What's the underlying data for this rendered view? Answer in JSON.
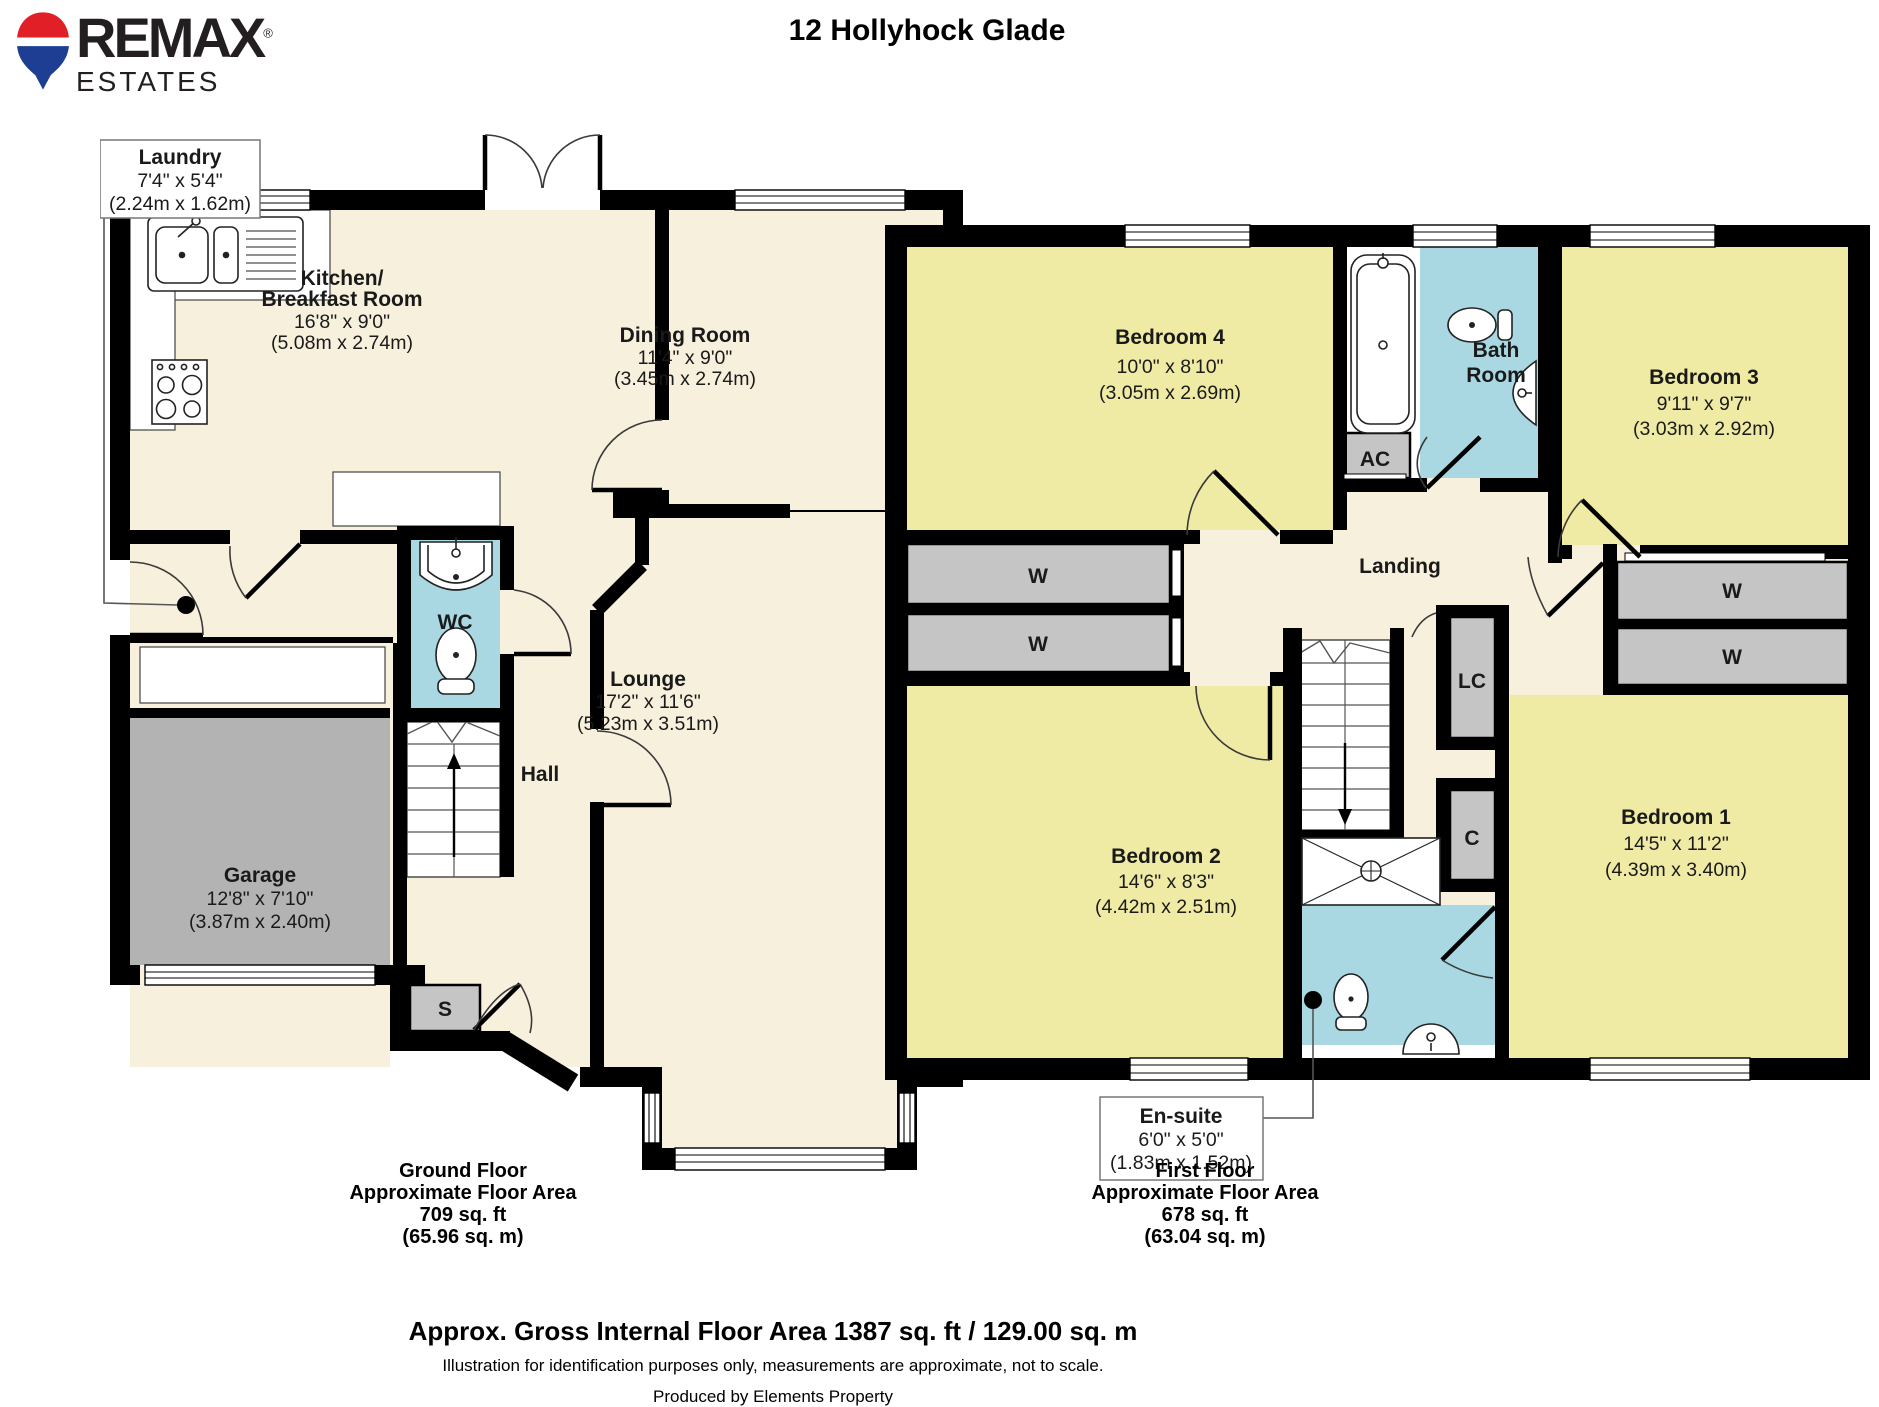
{
  "header": {
    "brand": "REMAX",
    "registered": "®",
    "brand_sub": "ESTATES",
    "title": "12 Hollyhock Glade"
  },
  "gf": {
    "label_box": {
      "name": "Laundry",
      "dims": "7'4\" x 5'4\"",
      "metric": "(2.24m x 1.62m)"
    },
    "rooms": {
      "kitchen": {
        "name1": "Kitchen/",
        "name2": "Breakfast Room",
        "dims": "16'8\" x 9'0\"",
        "metric": "(5.08m x 2.74m)"
      },
      "dining": {
        "name": "Dining Room",
        "dims": "11'4\" x 9'0\"",
        "metric": "(3.45m x 2.74m)"
      },
      "wc": {
        "name": "WC"
      },
      "garage": {
        "name": "Garage",
        "dims": "12'8\" x 7'10\"",
        "metric": "(3.87m x 2.40m)"
      },
      "hall": {
        "name": "Hall"
      },
      "lounge": {
        "name": "Lounge",
        "dims": "17'2\" x 11'6\"",
        "metric": "(5.23m x 3.51m)"
      },
      "store": {
        "name": "S"
      }
    },
    "footer": {
      "l1": "Ground Floor",
      "l2": "Approximate Floor Area",
      "l3": "709 sq. ft",
      "l4": "(65.96 sq. m)"
    }
  },
  "ff": {
    "label_box": {
      "name": "En-suite",
      "dims": "6'0\" x 5'0\"",
      "metric": "(1.83m x 1.52m)"
    },
    "rooms": {
      "bedroom4": {
        "name": "Bedroom 4",
        "dims": "10'0\" x 8'10\"",
        "metric": "(3.05m x 2.69m)"
      },
      "bathroom": {
        "name1": "Bath",
        "name2": "Room"
      },
      "bedroom3": {
        "name": "Bedroom 3",
        "dims": "9'11\" x 9'7\"",
        "metric": "(3.03m x 2.92m)"
      },
      "ac": {
        "name": "AC"
      },
      "landing": {
        "name": "Landing"
      },
      "w": {
        "name": "W"
      },
      "lc": {
        "name": "LC"
      },
      "c": {
        "name": "C"
      },
      "bedroom2": {
        "name": "Bedroom 2",
        "dims": "14'6\" x 8'3\"",
        "metric": "(4.42m x 2.51m)"
      },
      "bedroom1": {
        "name": "Bedroom 1",
        "dims": "14'5\" x 11'2\"",
        "metric": "(4.39m x 3.40m)"
      }
    },
    "footer": {
      "l1": "First Floor",
      "l2": "Approximate Floor Area",
      "l3": "678 sq. ft",
      "l4": "(63.04 sq. m)"
    }
  },
  "footer": {
    "area": "Approx. Gross Internal Floor Area 1387 sq. ft / 129.00 sq. m",
    "disclaimer": "Illustration for identification purposes only, measurements are approximate, not to scale.",
    "credit": "Produced by Elements Property"
  },
  "colors": {
    "floor": "#f7f0dd",
    "bedroom": "#f0eba4",
    "wet_room": "#a9d8e2",
    "garage": "#b3b3b3",
    "cupboard": "#c5c5c5",
    "wall": "#000000",
    "balloon_red": "#e01f26",
    "balloon_blue": "#1d3e92"
  }
}
